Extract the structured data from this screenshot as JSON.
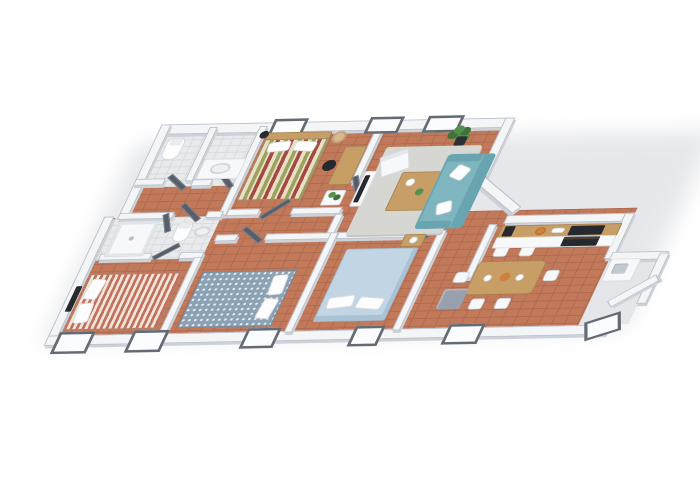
{
  "scene": {
    "title": "3D rendered apartment floor plan, isometric top view",
    "style": "3d-architectural-render",
    "background": "#ffffff"
  },
  "palette": {
    "floor_tile": "#c2795a",
    "floor_grout": "#ad6a4e",
    "bath_floor": "#e8eaec",
    "bath_grout": "#d7dade",
    "wall_top": "#f4f5f7",
    "wall_side": "#cdd2d9",
    "wall_edge": "#b9bfc8",
    "door": "#575e69",
    "door_edge": "#7d848e",
    "window_frame": "#646b74",
    "window_pane": "#fbfcfd",
    "wood": "#c79e66",
    "wood_dark": "#a98250",
    "white_furn": "#f7f8f9",
    "furn_edge": "#d9dce0",
    "sofa": "#7eb5bf",
    "sofa_dark": "#69a5b1",
    "rug": "#d6d7d3",
    "bed_blue": "#c2d5e5",
    "bed_blue_dark": "#a9c2d6",
    "stripe_olive": "#9aa45e",
    "stripe_red": "#a44b41",
    "stripe_cream": "#e9dfc6",
    "bed3_red": "#c4705f",
    "bed3_cream": "#efe6da",
    "bed4_base": "#8ba1b4",
    "bed4_dot": "#e9edf0",
    "plant": "#55904c",
    "plant_dark": "#3e7238",
    "pot": "#2e3134",
    "appliance": "#26292d",
    "metal": "#97a0ac",
    "shadow": "#c9ccd2"
  },
  "rooms": [
    {
      "id": "bathroom-1",
      "name": "Bathroom 1 (top left)",
      "floor": "light tile",
      "furniture": [
        "toilet",
        "vanity with basin"
      ]
    },
    {
      "id": "bedroom-1",
      "name": "Bedroom 1 (top middle)",
      "floor": "terracotta tile",
      "furniture": [
        "double bed with green/red striped cover",
        "two pillows",
        "floor lamp",
        "pendant lamp",
        "desk",
        "office chair",
        "plant shelf"
      ]
    },
    {
      "id": "living-room",
      "name": "Living room (top right)",
      "floor": "terracotta tile",
      "furniture": [
        "teal sofa with white cushions",
        "white armchair",
        "wooden coffee table",
        "gray area rug",
        "potted plant",
        "tv console with tv"
      ]
    },
    {
      "id": "dining-area",
      "name": "Dining area",
      "floor": "terracotta tile",
      "furniture": [
        "wooden dining table",
        "six white chairs"
      ]
    },
    {
      "id": "kitchen",
      "name": "Kitchen (right nook)",
      "floor": "terracotta tile",
      "furniture": [
        "counter with wooden top",
        "black cooktop",
        "coffee machine",
        "fruit bowl",
        "dark drawer unit",
        "gray stool"
      ]
    },
    {
      "id": "utility-room",
      "name": "Utility room (far right)",
      "floor": "gray tile",
      "furniture": [
        "counter with sink"
      ]
    },
    {
      "id": "bathroom-2",
      "name": "Bathroom 2 (left)",
      "floor": "light tile",
      "furniture": [
        "walk-in shower",
        "toilet",
        "small sink"
      ]
    },
    {
      "id": "bedroom-2",
      "name": "Bedroom 2 (center)",
      "floor": "terracotta tile",
      "furniture": [
        "double bed with light blue cover",
        "wooden nightstand",
        "table lamp"
      ]
    },
    {
      "id": "bedroom-3",
      "name": "Bedroom 3 (bottom far left)",
      "floor": "terracotta tile",
      "furniture": [
        "double bed with red striped cover",
        "wall tv"
      ]
    },
    {
      "id": "bedroom-4",
      "name": "Bedroom 4 (bottom left)",
      "floor": "terracotta tile",
      "furniture": [
        "double bed with blue patterned cover"
      ]
    },
    {
      "id": "hallway",
      "name": "Hallway",
      "floor": "terracotta tile",
      "furniture": []
    }
  ],
  "openings": {
    "windows_top_wall": 3,
    "windows_bottom_wall": 6,
    "interior_doors_dark_gray": 9
  }
}
